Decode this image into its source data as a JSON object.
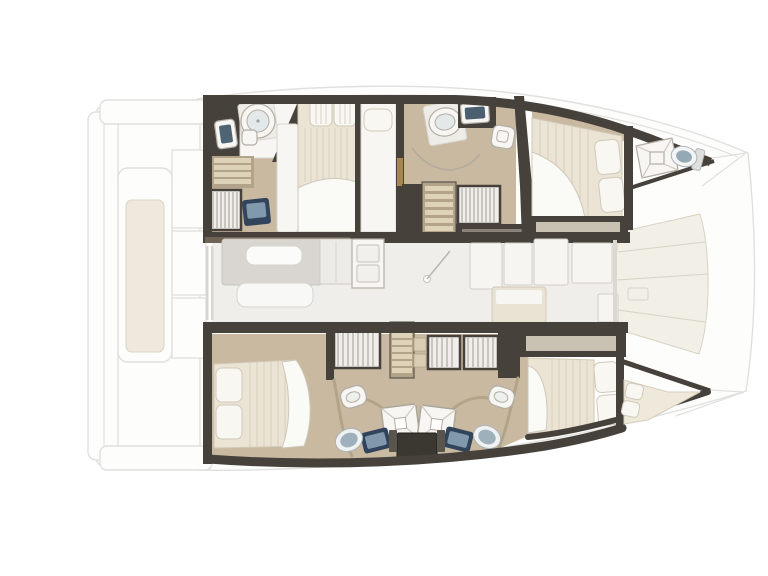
{
  "document": {
    "type": "floor-plan",
    "subject": "catamaran interior layout, top-down view, bow pointing right",
    "text_visible": "none"
  },
  "colors": {
    "wall": "#46413b",
    "wallBrown": "#6f6356",
    "floorTan": "#c8b9a0",
    "floorTanDark": "#b3a489",
    "stepTread": "#ded3b8",
    "louver": "#efeeea",
    "louverLine": "#a19c92",
    "bedCream": "#ebe4d4",
    "bedStroke": "#d2c9b6",
    "bedQuilt": "#d8cfbb",
    "pillow": "#f8f7f2",
    "pillowLine": "#cfc9ba",
    "duvet": "#fafaf7",
    "roomWhite": "#f7f6f3",
    "roomStroke": "#d8d5cf",
    "fixtureStroke": "#b2aea5",
    "navy": "#32445c",
    "steelBlue": "#8099ad",
    "sinkBlue": "#9db0bb",
    "sinkRim": "#f0f2f2",
    "showerX": "#ccc8be",
    "saloonFloor": "#f0eeea",
    "sofaGray": "#d9d6d1",
    "seatWhite": "#f8f8f6",
    "galleyWhite": "#f6f5f2",
    "galleyStroke": "#d2cfc8",
    "island": "#e9e3d3",
    "extFill": "#fdfdfc",
    "extLine": "#e0e0de",
    "deckCream": "#f2efe7",
    "deckLine": "#d9d3c4",
    "creamInner": "#efe9dd",
    "consoleDark": "#3b3731",
    "doorWood": "#a8854f",
    "glassLine": "#d8d5ce",
    "shelfGray": "#c9c1b2",
    "arcLine": "#b3ab9d"
  },
  "plan": {
    "stern_deck": [
      "swim-platform",
      "aft-crossbeams",
      "cockpit-lounge",
      "cockpit-seats"
    ],
    "saloon": [
      "sofa",
      "table",
      "bench-seat",
      "cabinet",
      "galley-double-sink",
      "entry-door-swing",
      "galley-counters",
      "galley-island",
      "windshield"
    ],
    "upper_hull": [
      "aft-bathroom-round-shower",
      "aft-bathroom-sink",
      "aft-bathroom-toilet",
      "steps",
      "wardrobe",
      "vanity-sink",
      "aft-double-bed",
      "single-berth",
      "mid-bathroom-shower",
      "mid-bathroom-sink",
      "mid-bathroom-toilet",
      "companionway-stairs",
      "louvered-locker",
      "forward-double-bed",
      "bow-hatch",
      "bow-toilet"
    ],
    "lower_hull": [
      "aft-double-bed",
      "wardrobes",
      "companionway-stairs",
      "left-shower",
      "right-shower",
      "left-toilet",
      "right-toilet",
      "left-round-sink",
      "right-round-sink",
      "left-vanity",
      "right-vanity",
      "center-console",
      "forward-double-bed",
      "bow-berth"
    ],
    "foredeck": [
      "deck-panels",
      "deck-hatch",
      "bow-tips"
    ]
  }
}
